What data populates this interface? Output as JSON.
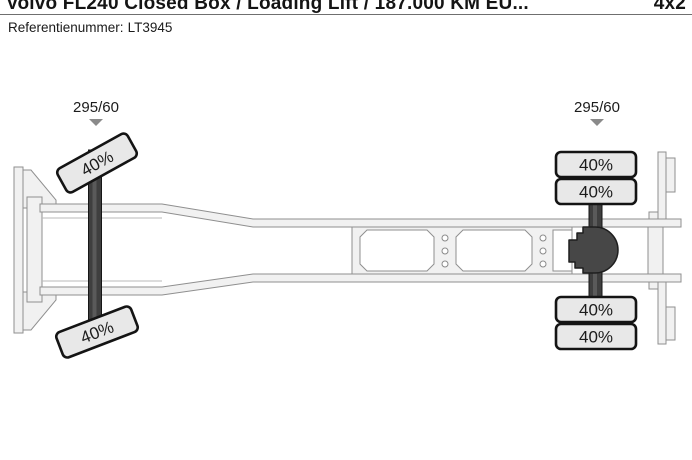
{
  "header": {
    "title": "Volvo FL240 Closed Box / Loading Lift / 187.000 KM EU...",
    "drive_config": "4x2"
  },
  "reference": {
    "label": "Referentienummer:",
    "value": "LT3945"
  },
  "diagram": {
    "type": "truck-chassis-top-view",
    "front_axle": {
      "tire_size": "295/60",
      "tires": [
        {
          "position": "left",
          "tread_remaining": "40%"
        },
        {
          "position": "right",
          "tread_remaining": "40%"
        }
      ]
    },
    "rear_axle": {
      "tire_size": "295/60",
      "tires": [
        {
          "position": "left-outer",
          "tread_remaining": "40%"
        },
        {
          "position": "left-inner",
          "tread_remaining": "40%"
        },
        {
          "position": "right-inner",
          "tread_remaining": "40%"
        },
        {
          "position": "right-outer",
          "tread_remaining": "40%"
        }
      ]
    },
    "colors": {
      "tire_fill": "#e8e8e8",
      "tire_border": "#141414",
      "axle": "#3f3f3f",
      "frame_fill": "#f1f1f1",
      "frame_stroke": "#8f8f8f",
      "marker": "#8a8a8a",
      "text": "#1c1c1c"
    }
  }
}
